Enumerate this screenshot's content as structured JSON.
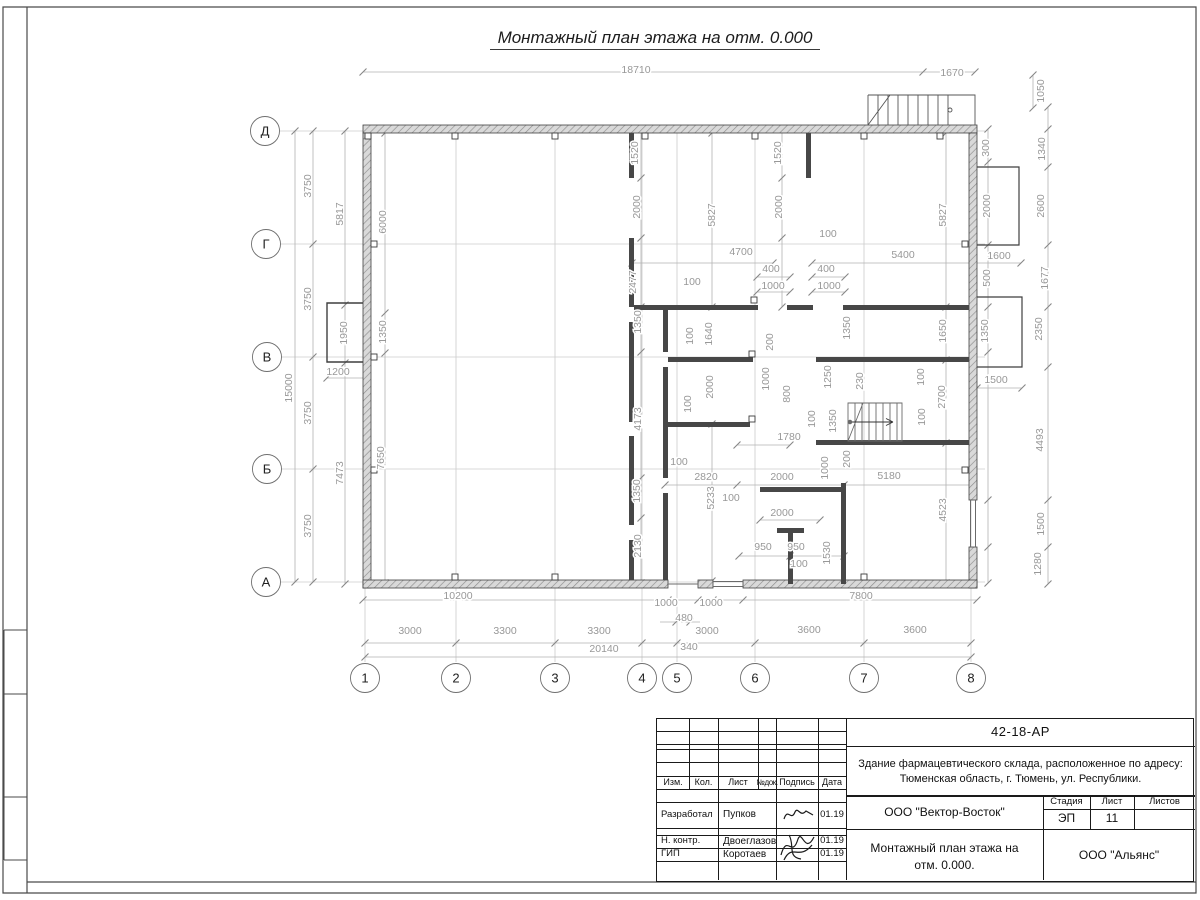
{
  "title": "Монтажный план этажа на отм. 0.000",
  "plan": {
    "axis_rows": [
      {
        "label": "Д",
        "x": 265,
        "y": 131
      },
      {
        "label": "Г",
        "x": 266,
        "y": 244
      },
      {
        "label": "В",
        "x": 267,
        "y": 357
      },
      {
        "label": "Б",
        "x": 267,
        "y": 469
      },
      {
        "label": "А",
        "x": 266,
        "y": 582
      }
    ],
    "axis_cols": [
      {
        "label": "1",
        "x": 365,
        "y": 678
      },
      {
        "label": "2",
        "x": 456,
        "y": 678
      },
      {
        "label": "3",
        "x": 555,
        "y": 678
      },
      {
        "label": "4",
        "x": 642,
        "y": 678
      },
      {
        "label": "5",
        "x": 677,
        "y": 678
      },
      {
        "label": "6",
        "x": 755,
        "y": 678
      },
      {
        "label": "7",
        "x": 864,
        "y": 678
      },
      {
        "label": "8",
        "x": 971,
        "y": 678
      }
    ],
    "dim_labels": [
      [
        "18710",
        636,
        69,
        0
      ],
      [
        "1670",
        952,
        72,
        0
      ],
      [
        "1050",
        1040,
        91,
        1
      ],
      [
        "3750",
        307,
        186,
        1
      ],
      [
        "3750",
        307,
        299,
        1
      ],
      [
        "3750",
        307,
        413,
        1
      ],
      [
        "3750",
        307,
        526,
        1
      ],
      [
        "15000",
        288,
        388,
        1
      ],
      [
        "5817",
        339,
        214,
        1
      ],
      [
        "1950",
        343,
        333,
        1
      ],
      [
        "7473",
        339,
        473,
        1
      ],
      [
        "6000",
        382,
        222,
        1
      ],
      [
        "1350",
        382,
        332,
        1
      ],
      [
        "7650",
        380,
        458,
        1
      ],
      [
        "1200",
        338,
        371,
        0
      ],
      [
        "1520",
        634,
        153,
        1
      ],
      [
        "2000",
        636,
        207,
        1
      ],
      [
        "2477",
        632,
        282,
        1
      ],
      [
        "5827",
        711,
        215,
        1
      ],
      [
        "1520",
        777,
        153,
        1
      ],
      [
        "2000",
        778,
        207,
        1
      ],
      [
        "4700",
        741,
        251,
        0
      ],
      [
        "100",
        692,
        281,
        0
      ],
      [
        "100",
        828,
        233,
        0
      ],
      [
        "400",
        771,
        268,
        0
      ],
      [
        "1000",
        773,
        285,
        0
      ],
      [
        "400",
        826,
        268,
        0
      ],
      [
        "1000",
        829,
        285,
        0
      ],
      [
        "5400",
        903,
        254,
        0
      ],
      [
        "5827",
        942,
        215,
        1
      ],
      [
        "1600",
        999,
        255,
        0
      ],
      [
        "300",
        985,
        148,
        1
      ],
      [
        "1340",
        1041,
        149,
        1
      ],
      [
        "2000",
        986,
        206,
        1
      ],
      [
        "2600",
        1040,
        206,
        1
      ],
      [
        "500",
        986,
        278,
        1
      ],
      [
        "1677",
        1044,
        278,
        1
      ],
      [
        "1350",
        984,
        331,
        1
      ],
      [
        "1650",
        942,
        331,
        1
      ],
      [
        "2350",
        1038,
        329,
        1
      ],
      [
        "1500",
        996,
        379,
        0
      ],
      [
        "2700",
        941,
        397,
        1
      ],
      [
        "4493",
        1039,
        440,
        1
      ],
      [
        "1500",
        1040,
        524,
        1
      ],
      [
        "1280",
        1037,
        564,
        1
      ],
      [
        "1350",
        637,
        322,
        1
      ],
      [
        "100",
        689,
        336,
        1
      ],
      [
        "1640",
        708,
        334,
        1
      ],
      [
        "200",
        769,
        342,
        1
      ],
      [
        "2000",
        709,
        387,
        1
      ],
      [
        "100",
        687,
        404,
        1
      ],
      [
        "1000",
        765,
        379,
        1
      ],
      [
        "800",
        786,
        394,
        1
      ],
      [
        "1250",
        827,
        377,
        1
      ],
      [
        "1350",
        846,
        328,
        1
      ],
      [
        "230",
        859,
        381,
        1
      ],
      [
        "100",
        811,
        419,
        1
      ],
      [
        "100",
        920,
        377,
        1
      ],
      [
        "100",
        921,
        417,
        1
      ],
      [
        "1350",
        832,
        421,
        1
      ],
      [
        "1780",
        789,
        436,
        0
      ],
      [
        "4173",
        637,
        419,
        1
      ],
      [
        "100",
        679,
        461,
        0
      ],
      [
        "2820",
        706,
        476,
        0
      ],
      [
        "2000",
        782,
        476,
        0
      ],
      [
        "5180",
        889,
        475,
        0
      ],
      [
        "200",
        846,
        459,
        1
      ],
      [
        "1000",
        824,
        468,
        1
      ],
      [
        "1350",
        636,
        491,
        1
      ],
      [
        "5233",
        710,
        498,
        1
      ],
      [
        "2130",
        637,
        546,
        1
      ],
      [
        "100",
        731,
        497,
        0
      ],
      [
        "2000",
        782,
        512,
        0
      ],
      [
        "950",
        763,
        546,
        0
      ],
      [
        "950",
        796,
        546,
        0
      ],
      [
        "100",
        799,
        563,
        0
      ],
      [
        "1530",
        826,
        553,
        1
      ],
      [
        "4523",
        942,
        510,
        1
      ],
      [
        "10200",
        458,
        595,
        0
      ],
      [
        "1000",
        666,
        602,
        0
      ],
      [
        "1000",
        711,
        602,
        0
      ],
      [
        "7800",
        861,
        595,
        0
      ],
      [
        "480",
        684,
        617,
        0
      ],
      [
        "3000",
        410,
        630,
        0
      ],
      [
        "3300",
        505,
        630,
        0
      ],
      [
        "3300",
        599,
        630,
        0
      ],
      [
        "3000",
        707,
        630,
        0
      ],
      [
        "3600",
        809,
        629,
        0
      ],
      [
        "3600",
        915,
        629,
        0
      ],
      [
        "340",
        689,
        646,
        0
      ],
      [
        "20140",
        604,
        648,
        0
      ]
    ]
  },
  "title_block": {
    "doc_number": "42-18-АР",
    "project_line1": "Здание фармацевтического склада, расположенное по адресу:",
    "project_line2": "Тюменская область, г. Тюмень, ул. Республики.",
    "columns": {
      "izm": "Изм.",
      "kol": "Кол.",
      "list": "Лист",
      "ndok": "№док.",
      "podpis": "Подпись",
      "data": "Дата"
    },
    "rows": [
      {
        "role": "Разработал",
        "name": "Пупков",
        "date": "01.19"
      },
      {
        "role": "Н. контр.",
        "name": "Двоеглазов",
        "date": "01.19"
      },
      {
        "role": "ГИП",
        "name": "Коротаев",
        "date": "01.19"
      }
    ],
    "org": "ООО \"Вектор-Восток\"",
    "stage_label": "Стадия",
    "sheet_label": "Лист",
    "sheets_label": "Листов",
    "stage": "ЭП",
    "sheet": "11",
    "sheets": "",
    "drawing_title_line1": "Монтажный план этажа на",
    "drawing_title_line2": "отм. 0.000.",
    "company": "ООО \"Альянс\""
  }
}
